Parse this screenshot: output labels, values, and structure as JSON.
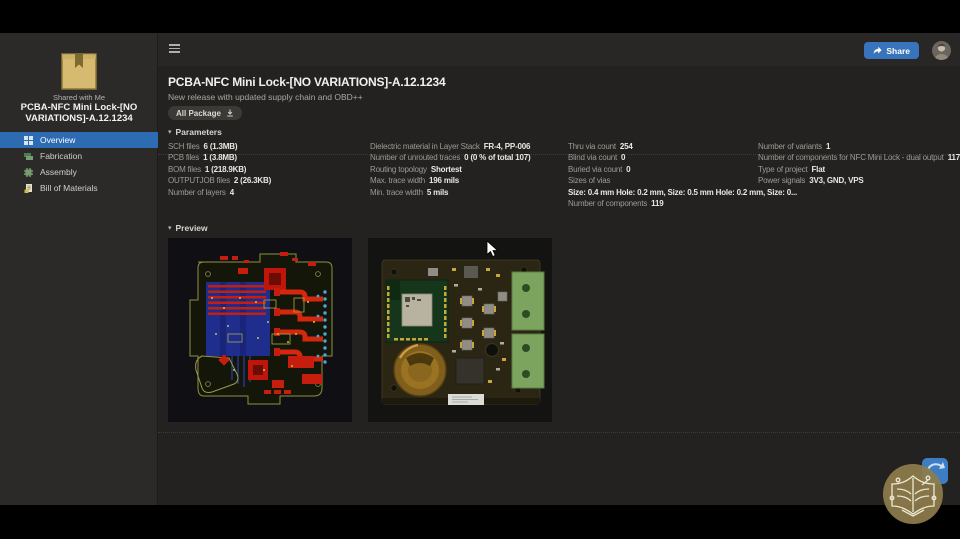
{
  "topbar": {
    "share_label": "Share"
  },
  "sidebar": {
    "shared_with": "Shared with Me",
    "project_title": "PCBA-NFC Mini Lock-[NO VARIATIONS]-A.12.1234",
    "nav": [
      {
        "label": "Overview",
        "icon": "overview-grid-icon",
        "active": true
      },
      {
        "label": "Fabrication",
        "icon": "fabrication-layers-icon",
        "active": false
      },
      {
        "label": "Assembly",
        "icon": "assembly-chip-icon",
        "active": false
      },
      {
        "label": "Bill of Materials",
        "icon": "bom-document-icon",
        "active": false
      }
    ]
  },
  "header": {
    "title": "PCBA-NFC Mini Lock-[NO VARIATIONS]-A.12.1234",
    "subtitle": "New release with updated supply chain and OBD++",
    "package_button_label": "All Package"
  },
  "parameters": {
    "section_label": "Parameters",
    "columns": [
      {
        "rows": [
          {
            "label": "SCH files",
            "value": "6 (1.3MB)"
          },
          {
            "label": "PCB files",
            "value": "1 (3.8MB)"
          },
          {
            "label": "BOM files",
            "value": "1 (218.9KB)"
          },
          {
            "label": "OUTPUTJOB files",
            "value": "2 (26.3KB)"
          },
          {
            "label": "Number of layers",
            "value": "4"
          }
        ]
      },
      {
        "rows": [
          {
            "label": "Dielectric material in Layer Stack",
            "value": "FR-4, PP-006"
          },
          {
            "label": "Number of unrouted traces",
            "value": "0 (0 % of total 107)"
          },
          {
            "label": "Routing topology",
            "value": "Shortest"
          },
          {
            "label": "Max. trace width",
            "value": "196 mils"
          },
          {
            "label": "Min. trace width",
            "value": "5 mils"
          }
        ]
      },
      {
        "rows": [
          {
            "label": "Thru via count",
            "value": "254"
          },
          {
            "label": "Blind via count",
            "value": "0"
          },
          {
            "label": "Buried via count",
            "value": "0"
          },
          {
            "label": "Sizes of vias",
            "value": ""
          },
          {
            "label": "",
            "value": "Size: 0.4 mm Hole: 0.2 mm, Size: 0.5 mm Hole: 0.2 mm, Size: 0..."
          },
          {
            "label": "Number of components",
            "value": "119"
          }
        ]
      },
      {
        "rows": [
          {
            "label": "Number of variants",
            "value": "1"
          },
          {
            "label": "Number of components for NFC Mini Lock - dual output",
            "value": "117"
          },
          {
            "label": "Type of project",
            "value": "Flat"
          },
          {
            "label": "Power signals",
            "value": "3V3, GND, VPS"
          }
        ]
      }
    ]
  },
  "preview": {
    "section_label": "Preview",
    "images": [
      {
        "name": "pcb-2d-layout-preview"
      },
      {
        "name": "pcb-3d-render-preview"
      }
    ]
  },
  "colors": {
    "accent_blue": "#3874bb",
    "nav_active_blue": "#2d6bb2",
    "page_bg": "#242220",
    "sidebar_bg": "#2b2a28",
    "letterbox": "#000000",
    "label_text": "#9b9b95",
    "value_text": "#e8e8e3"
  }
}
